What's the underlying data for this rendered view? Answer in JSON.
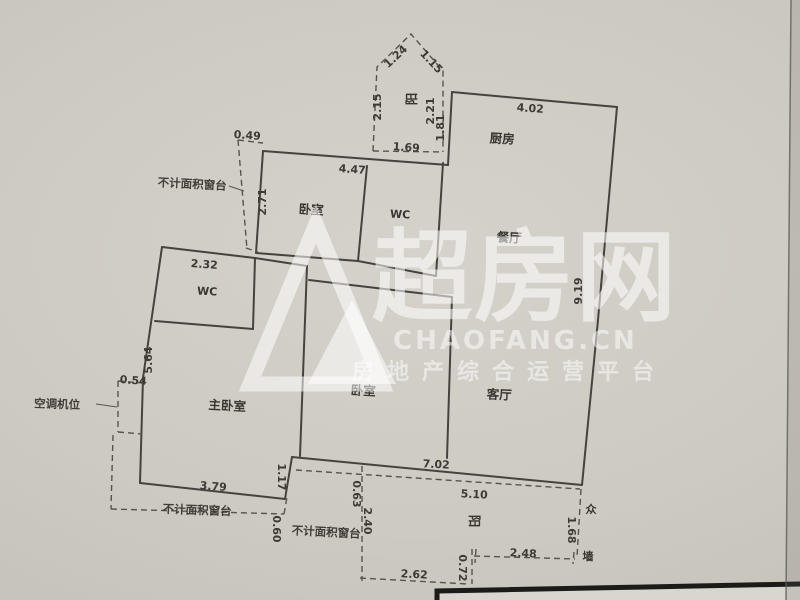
{
  "watermark": {
    "brand": "超房网",
    "site": "CHAOFANG.CN",
    "tagline": "房地产综合运营平台"
  },
  "plan": {
    "rooms": {
      "bedroom_top": "卧室",
      "wc_top": "WC",
      "kitchen": "厨房",
      "dining": "餐厅",
      "living": "客厅",
      "bedroom_middle": "卧室",
      "master_bedroom": "主卧室",
      "wc_master": "WC",
      "balcony_top": "阳",
      "balcony_bottom": "阳"
    },
    "annotations": {
      "sill_top_left": "不计面积窗台",
      "sill_bottom_left": "不计面积窗台",
      "sill_bottom_middle": "不计面积窗台",
      "ac_unit": "空调机位",
      "wall_char_top": "众",
      "wall_char_bottom": "墙"
    },
    "dimensions": {
      "win_0_49": "0.49",
      "bed_2_71": "2.71",
      "wc2_2_32": "2.32",
      "left_5_64": "5.64",
      "ac_0_54": "0.54",
      "master_3_79": "3.79",
      "step_1_17": "1.17",
      "sill_0_60": "0.60",
      "pent_2_15": "2.15",
      "pent_1_24": "1.24",
      "pent_1_15": "1.15",
      "pent_2_21": "2.21",
      "pent_1_69": "1.69",
      "kit_1_81": "1.81",
      "top_4_47": "4.47",
      "kit_4_02": "4.02",
      "right_9_19": "9.19",
      "bottom_7_02": "7.02",
      "balc_5_10": "5.10",
      "balc_1_68": "1.68",
      "balc_2_48": "2.48",
      "balc_0_72": "0.72",
      "balc_2_62": "2.62",
      "balc_2_40": "2.40",
      "balc_0_63": "0.63"
    }
  }
}
